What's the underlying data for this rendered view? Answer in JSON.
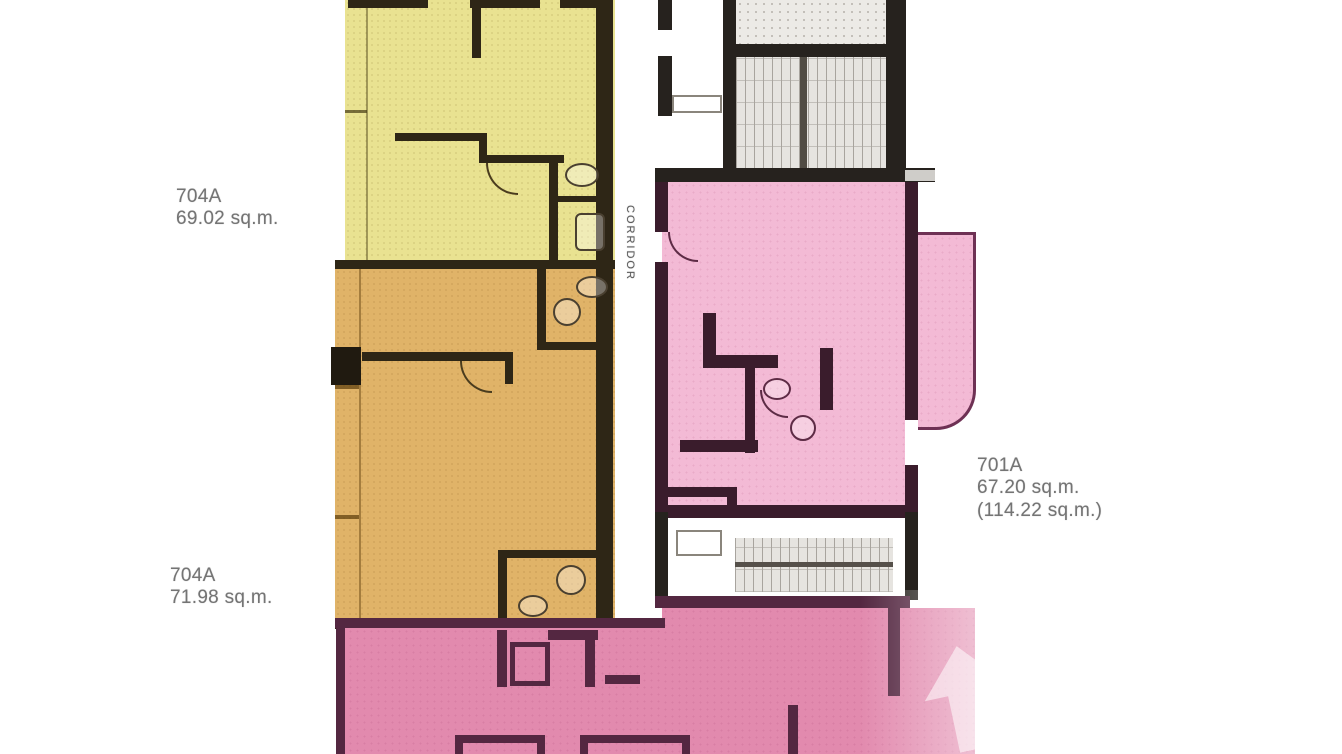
{
  "plan": {
    "type": "apartment-floor-plan",
    "corridor_label": "CORRIDOR",
    "labels": {
      "unit_a": {
        "number": "704A",
        "area": "69.02 sq.m."
      },
      "unit_b": {
        "number": "704A",
        "area": "71.98 sq.m."
      },
      "unit_c": {
        "number": "701A",
        "area": "67.20 sq.m.",
        "area_total": "(114.22 sq.m.)"
      }
    },
    "units": [
      {
        "label": "704A",
        "area": "69.02 sq.m.",
        "fill": "#e9e291"
      },
      {
        "label": "704A",
        "area": "71.98 sq.m.",
        "fill": "#e0b368"
      },
      {
        "label": "701A",
        "area": "67.20 sq.m.",
        "area_total": "(114.22 sq.m.)",
        "fill": "#f3bad5"
      },
      {
        "label": "",
        "fill": "#e28aae"
      }
    ],
    "colors": {
      "wall_dark": "#2e2616",
      "wall_core": "#26221e",
      "wall_pink": "#3a1c2c",
      "label_text": "#747474",
      "background": "#ffffff"
    }
  }
}
